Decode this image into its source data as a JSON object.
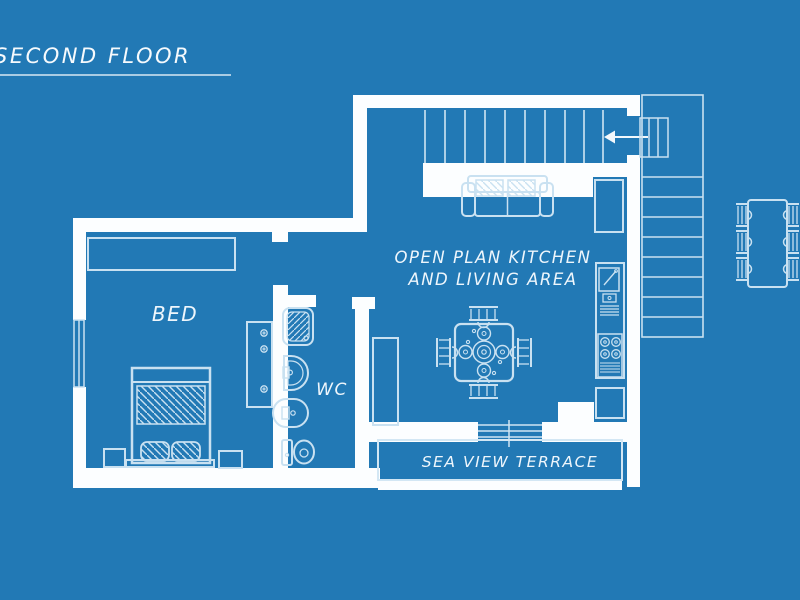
{
  "title": {
    "label": "SECOND FLOOR"
  },
  "rooms": {
    "bedroom": "BED",
    "wc": "WC",
    "kitchen_line1": "OPEN PLAN KITCHEN",
    "kitchen_line2": "AND LIVING AREA",
    "terrace": "SEA VIEW TERRACE"
  },
  "colors": {
    "background": "#2279b5",
    "wall": "#fcfeff",
    "furniture_line": "#c9e1f1",
    "text": "#eef6fc"
  }
}
